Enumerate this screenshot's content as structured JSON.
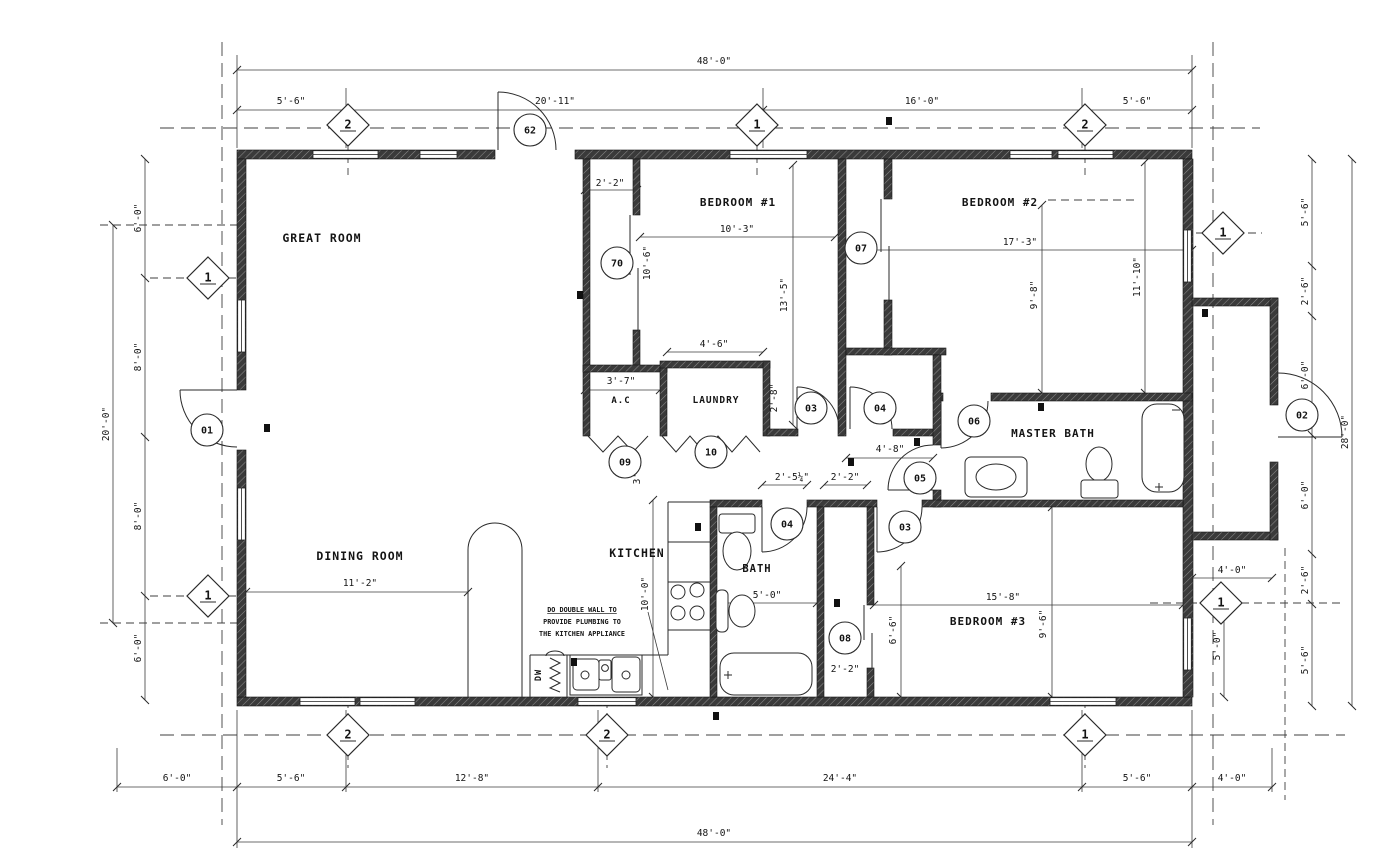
{
  "drawing_title": "residential-floor-plan",
  "colors": {
    "wall": "#3a3a3a",
    "wall_hatch": "#8a8a8a",
    "line": "#2a2a2a",
    "dash": "#3f3f3f",
    "text": "#141414",
    "background": "#ffffff"
  },
  "rooms": [
    {
      "label": "GREAT ROOM",
      "x": 322,
      "y": 242,
      "rot": 0,
      "size": 11.5
    },
    {
      "label": "DINING ROOM",
      "x": 360,
      "y": 560,
      "rot": 0,
      "size": 11.5
    },
    {
      "label": "KITCHEN",
      "x": 637,
      "y": 557,
      "rot": 0,
      "size": 11.5
    },
    {
      "label": "BEDROOM #1",
      "x": 738,
      "y": 206,
      "rot": 0,
      "size": 11
    },
    {
      "label": "BEDROOM #2",
      "x": 1000,
      "y": 206,
      "rot": 0,
      "size": 11
    },
    {
      "label": "BEDROOM #3",
      "x": 988,
      "y": 625,
      "rot": 0,
      "size": 11
    },
    {
      "label": "MASTER BATH",
      "x": 1053,
      "y": 437,
      "rot": 0,
      "size": 11
    },
    {
      "label": "BATH",
      "x": 757,
      "y": 572,
      "rot": 0,
      "size": 10.5
    },
    {
      "label": "LAUNDRY",
      "x": 716,
      "y": 403,
      "rot": 0,
      "size": 9.5
    },
    {
      "label": "A.C",
      "x": 621,
      "y": 403,
      "rot": 0,
      "size": 9
    },
    {
      "label": "DW",
      "x": 541,
      "y": 675,
      "rot": -90,
      "size": 8.5
    }
  ],
  "dimensions": [
    {
      "text": "48'-0\"",
      "x": 714,
      "y": 64,
      "rot": 0
    },
    {
      "text": "5'-6\"",
      "x": 291,
      "y": 104,
      "rot": 0
    },
    {
      "text": "20'-11\"",
      "x": 555,
      "y": 104,
      "rot": 0
    },
    {
      "text": "16'-0\"",
      "x": 922,
      "y": 104,
      "rot": 0
    },
    {
      "text": "5'-6\"",
      "x": 1137,
      "y": 104,
      "rot": 0
    },
    {
      "text": "6'-0\"",
      "x": 177,
      "y": 781,
      "rot": 0
    },
    {
      "text": "5'-6\"",
      "x": 291,
      "y": 781,
      "rot": 0
    },
    {
      "text": "12'-8\"",
      "x": 472,
      "y": 781,
      "rot": 0
    },
    {
      "text": "24'-4\"",
      "x": 840,
      "y": 781,
      "rot": 0
    },
    {
      "text": "5'-6\"",
      "x": 1137,
      "y": 781,
      "rot": 0
    },
    {
      "text": "4'-0\"",
      "x": 1232,
      "y": 781,
      "rot": 0
    },
    {
      "text": "48'-0\"",
      "x": 714,
      "y": 836,
      "rot": 0
    },
    {
      "text": "20'-0\"",
      "x": 109,
      "y": 424,
      "rot": -90
    },
    {
      "text": "6'-0\"",
      "x": 141,
      "y": 218,
      "rot": -90
    },
    {
      "text": "8'-0\"",
      "x": 141,
      "y": 357,
      "rot": -90
    },
    {
      "text": "8'-0\"",
      "x": 141,
      "y": 516,
      "rot": -90
    },
    {
      "text": "6'-0\"",
      "x": 141,
      "y": 648,
      "rot": -90
    },
    {
      "text": "5'-6\"",
      "x": 1308,
      "y": 212,
      "rot": -90
    },
    {
      "text": "2'-6\"",
      "x": 1308,
      "y": 291,
      "rot": -90
    },
    {
      "text": "6'-0\"",
      "x": 1308,
      "y": 375,
      "rot": -90
    },
    {
      "text": "6'-0\"",
      "x": 1308,
      "y": 495,
      "rot": -90
    },
    {
      "text": "2'-6\"",
      "x": 1308,
      "y": 580,
      "rot": -90
    },
    {
      "text": "5'-6\"",
      "x": 1308,
      "y": 660,
      "rot": -90
    },
    {
      "text": "28'-0\"",
      "x": 1348,
      "y": 432,
      "rot": -90
    },
    {
      "text": "4'-0\"",
      "x": 1232,
      "y": 573,
      "rot": 0
    },
    {
      "text": "5'-0\"",
      "x": 1220,
      "y": 646,
      "rot": -90
    },
    {
      "text": "2'-2\"",
      "x": 610,
      "y": 186,
      "rot": 0
    },
    {
      "text": "10'-3\"",
      "x": 737,
      "y": 232,
      "rot": 0
    },
    {
      "text": "13'-5\"",
      "x": 787,
      "y": 295,
      "rot": -90
    },
    {
      "text": "10'-6\"",
      "x": 650,
      "y": 263,
      "rot": -90
    },
    {
      "text": "4'-6\"",
      "x": 714,
      "y": 347,
      "rot": 0
    },
    {
      "text": "3'-7\"",
      "x": 621,
      "y": 384,
      "rot": 0
    },
    {
      "text": "2'-8\"",
      "x": 777,
      "y": 398,
      "rot": -90
    },
    {
      "text": "3'-5\"",
      "x": 640,
      "y": 470,
      "rot": -90
    },
    {
      "text": "17'-3\"",
      "x": 1020,
      "y": 245,
      "rot": 0
    },
    {
      "text": "9'-8\"",
      "x": 1037,
      "y": 295,
      "rot": -90
    },
    {
      "text": "11'-10\"",
      "x": 1140,
      "y": 277,
      "rot": -90
    },
    {
      "text": "4'-8\"",
      "x": 890,
      "y": 452,
      "rot": 0
    },
    {
      "text": "2'-5¼\"",
      "x": 792,
      "y": 480,
      "rot": 0
    },
    {
      "text": "2'-2\"",
      "x": 845,
      "y": 480,
      "rot": 0
    },
    {
      "text": "5'-0\"",
      "x": 767,
      "y": 598,
      "rot": 0
    },
    {
      "text": "6'-6\"",
      "x": 896,
      "y": 630,
      "rot": -90
    },
    {
      "text": "2'-2\"",
      "x": 845,
      "y": 672,
      "rot": 0
    },
    {
      "text": "10'-0\"",
      "x": 648,
      "y": 594,
      "rot": -90
    },
    {
      "text": "11'-2\"",
      "x": 360,
      "y": 586,
      "rot": 0
    },
    {
      "text": "15'-8\"",
      "x": 1003,
      "y": 600,
      "rot": 0
    },
    {
      "text": "9'-6\"",
      "x": 1046,
      "y": 624,
      "rot": -90
    }
  ],
  "door_tags": [
    {
      "label": "01",
      "x": 207,
      "y": 430
    },
    {
      "label": "62",
      "x": 530,
      "y": 130
    },
    {
      "label": "70",
      "x": 617,
      "y": 263
    },
    {
      "label": "07",
      "x": 861,
      "y": 248
    },
    {
      "label": "03",
      "x": 811,
      "y": 408
    },
    {
      "label": "04",
      "x": 880,
      "y": 408
    },
    {
      "label": "05",
      "x": 920,
      "y": 478
    },
    {
      "label": "06",
      "x": 974,
      "y": 421
    },
    {
      "label": "04",
      "x": 787,
      "y": 524
    },
    {
      "label": "03",
      "x": 905,
      "y": 527
    },
    {
      "label": "08",
      "x": 845,
      "y": 638
    },
    {
      "label": "09",
      "x": 625,
      "y": 462
    },
    {
      "label": "10",
      "x": 711,
      "y": 452
    },
    {
      "label": "02",
      "x": 1302,
      "y": 415
    }
  ],
  "section_markers": [
    {
      "label": "2",
      "x": 348,
      "y": 125
    },
    {
      "label": "1",
      "x": 757,
      "y": 125
    },
    {
      "label": "2",
      "x": 1085,
      "y": 125
    },
    {
      "label": "1",
      "x": 208,
      "y": 278
    },
    {
      "label": "1",
      "x": 208,
      "y": 596
    },
    {
      "label": "1",
      "x": 1223,
      "y": 233
    },
    {
      "label": "1",
      "x": 1221,
      "y": 603
    },
    {
      "label": "2",
      "x": 348,
      "y": 735
    },
    {
      "label": "2",
      "x": 607,
      "y": 735
    },
    {
      "label": "1",
      "x": 1085,
      "y": 735
    }
  ],
  "notes": {
    "kitchen_note_lines": [
      "DO DOUBLE WALL TO",
      "PROVIDE PLUMBING TO",
      "THE KITCHEN APPLIANCE"
    ],
    "x": 582,
    "y": 612,
    "line_height": 12
  }
}
